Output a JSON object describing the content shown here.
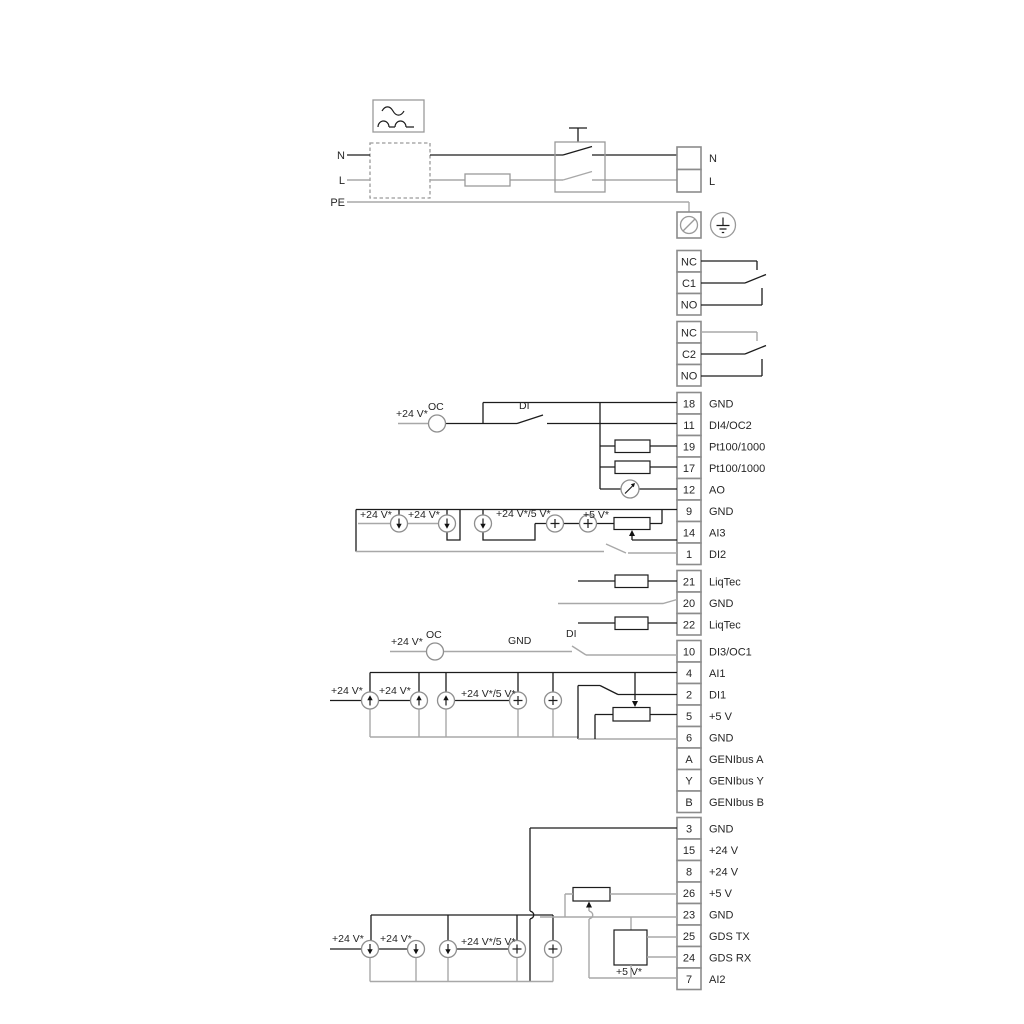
{
  "power": {
    "n_in": "N",
    "l_in": "L",
    "pe": "PE",
    "n_out": "N",
    "l_out": "L"
  },
  "relays": [
    {
      "nc": "NC",
      "common": "C1",
      "no": "NO"
    },
    {
      "nc": "NC",
      "common": "C2",
      "no": "NO"
    }
  ],
  "terminals": [
    {
      "num": "18",
      "label": "GND"
    },
    {
      "num": "11",
      "label": "DI4/OC2"
    },
    {
      "num": "19",
      "label": "Pt100/1000"
    },
    {
      "num": "17",
      "label": "Pt100/1000"
    },
    {
      "num": "12",
      "label": "AO"
    },
    {
      "num": "9",
      "label": "GND"
    },
    {
      "num": "14",
      "label": "AI3"
    },
    {
      "num": "1",
      "label": "DI2"
    },
    {
      "num": "21",
      "label": "LiqTec"
    },
    {
      "num": "20",
      "label": "GND"
    },
    {
      "num": "22",
      "label": "LiqTec"
    },
    {
      "num": "10",
      "label": "DI3/OC1"
    },
    {
      "num": "4",
      "label": "AI1"
    },
    {
      "num": "2",
      "label": "DI1"
    },
    {
      "num": "5",
      "label": "+5 V"
    },
    {
      "num": "6",
      "label": "GND"
    },
    {
      "num": "A",
      "label": "GENIbus A"
    },
    {
      "num": "Y",
      "label": "GENIbus Y"
    },
    {
      "num": "B",
      "label": "GENIbus B"
    },
    {
      "num": "3",
      "label": "GND"
    },
    {
      "num": "15",
      "label": "+24 V"
    },
    {
      "num": "8",
      "label": "+24 V"
    },
    {
      "num": "26",
      "label": "+5 V"
    },
    {
      "num": "23",
      "label": "GND"
    },
    {
      "num": "25",
      "label": "GDS TX"
    },
    {
      "num": "24",
      "label": "GDS RX"
    },
    {
      "num": "7",
      "label": "AI2"
    }
  ],
  "annotations": {
    "plus24": "+24 V*",
    "plus24or5": "+24 V*/5 V*",
    "plus5": "+5 V*",
    "oc": "OC",
    "di": "DI",
    "gnd": "GND"
  },
  "icons": {
    "ac_filter": "ac-filter-icon",
    "fuse": "fuse-symbol",
    "mains_switch": "mains-switch-symbol",
    "pe_screw": "pe-screw-icon",
    "earth": "earth-icon",
    "current_source": "current-source-icon",
    "voltage_source": "plus-source-icon",
    "gauge": "gauge-icon",
    "resistor": "resistor-symbol",
    "potentiometer": "potentiometer-symbol",
    "gds_sensor": "gds-sensor-box"
  },
  "colors": {
    "wire": "#1c1c1c",
    "wire_gray": "#a8a8a8",
    "cell_border": "#8c8c8c",
    "background": "#ffffff"
  }
}
